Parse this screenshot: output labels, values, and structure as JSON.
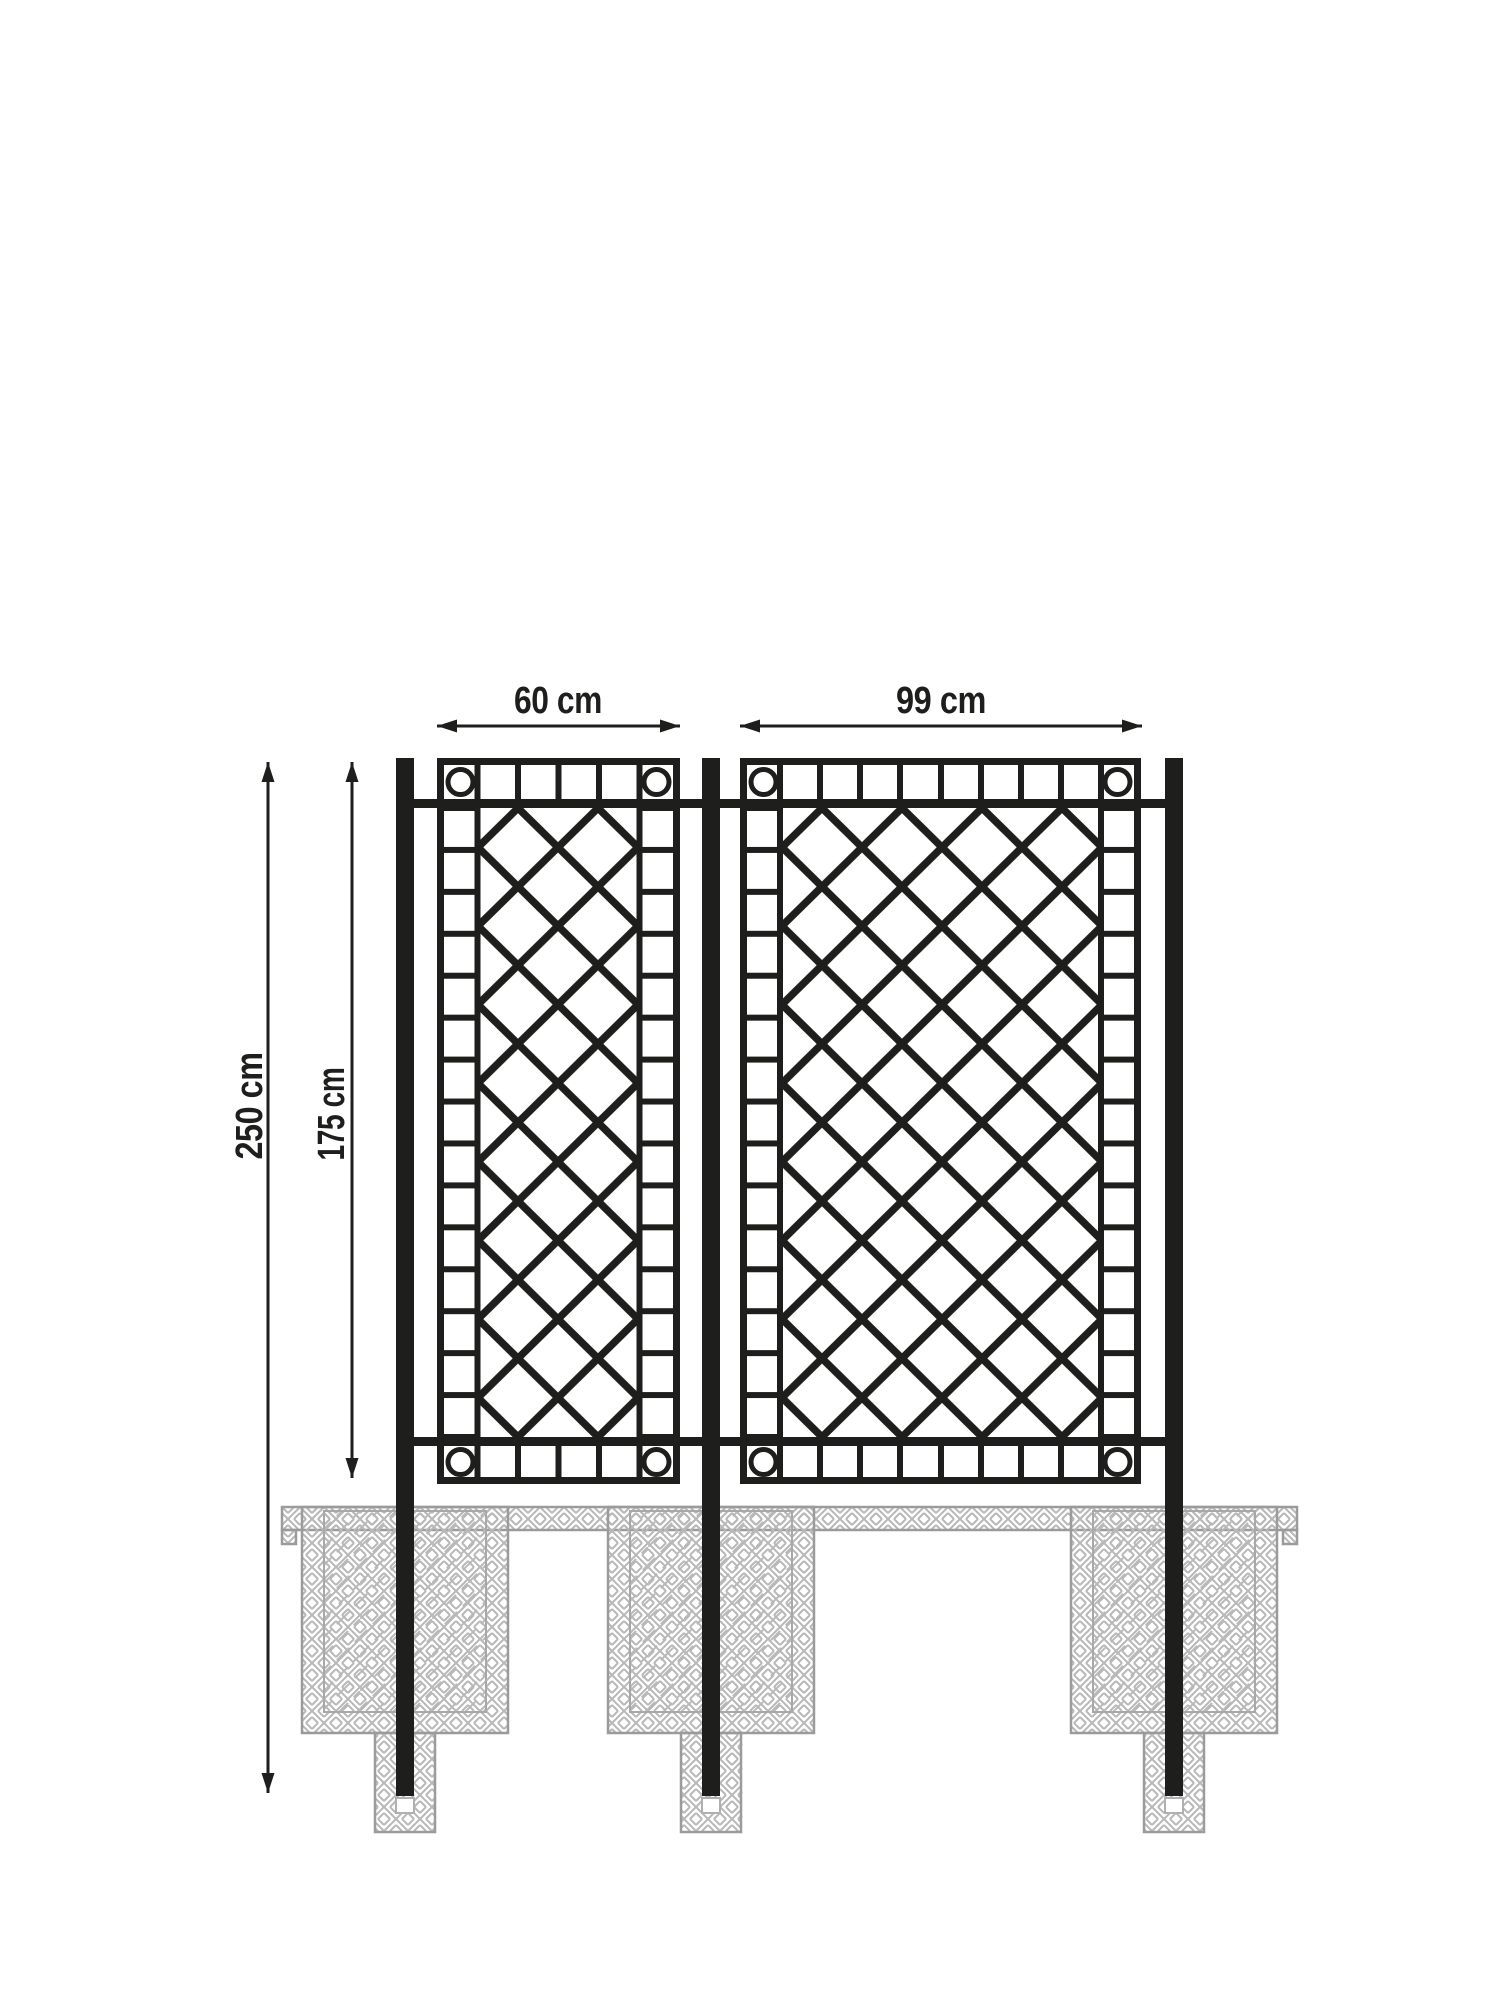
{
  "drawing": {
    "kind": "technical dimension drawing",
    "subject_labels": {
      "panel1_width": "60 cm",
      "panel2_width": "99 cm",
      "overall_height": "250 cm",
      "panel_height": "175 cm"
    },
    "colors": {
      "ink": "#1e1e1c",
      "foundation_outline": "#9b9b9b",
      "foundation_hatch": "#b8b8b8",
      "background": "#ffffff"
    }
  }
}
